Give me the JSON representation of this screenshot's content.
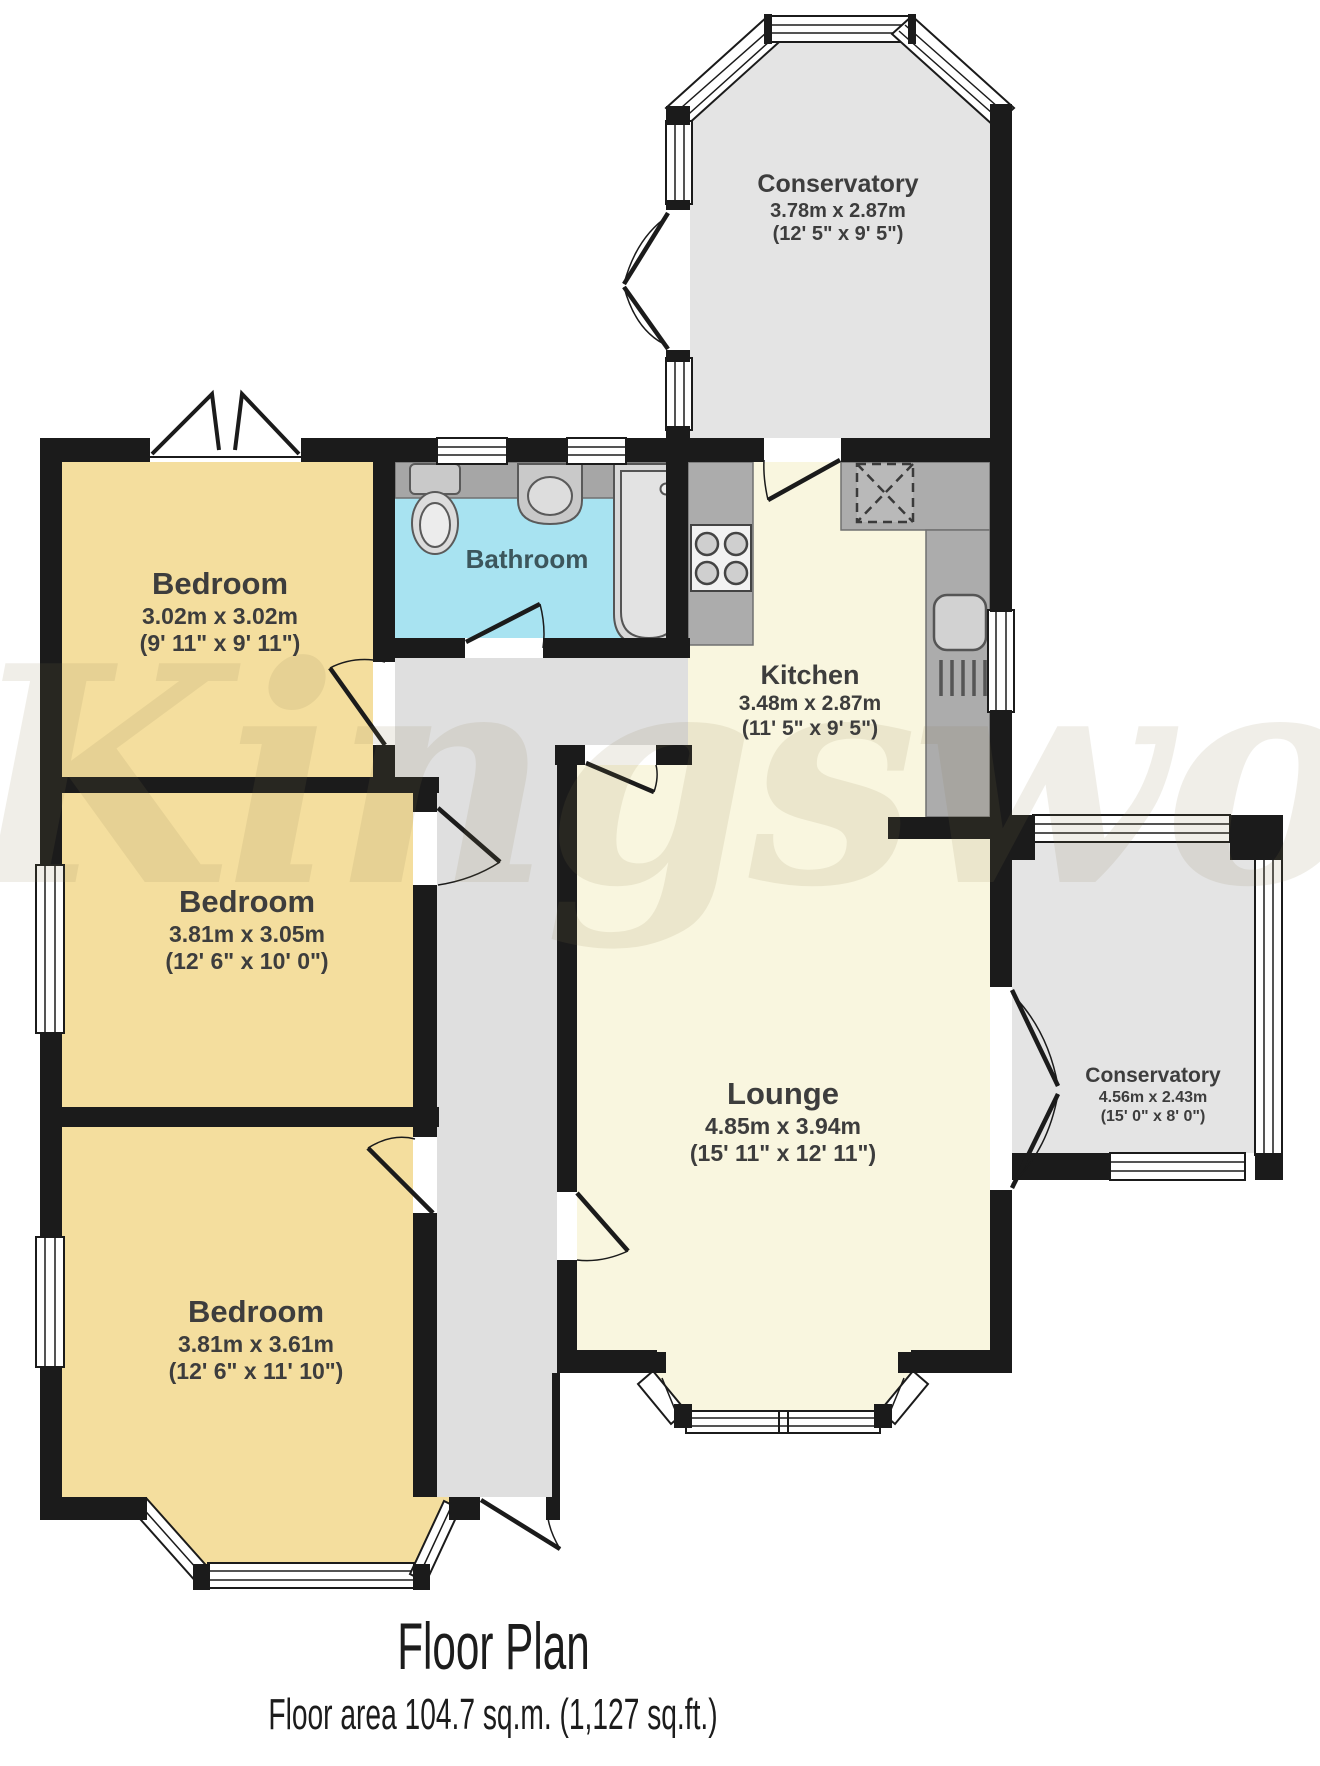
{
  "watermark_text": "Kingswood",
  "footer": {
    "title": "Floor Plan",
    "subtitle": "Floor area 104.7 sq.m. (1,127 sq.ft.)"
  },
  "rooms": {
    "conservatory_top": {
      "name": "Conservatory",
      "metric": "3.78m x 2.87m",
      "imperial": "(12' 5\" x 9' 5\")"
    },
    "bedroom_top": {
      "name": "Bedroom",
      "metric": "3.02m x 3.02m",
      "imperial": "(9' 11\" x 9' 11\")"
    },
    "bathroom": {
      "name": "Bathroom"
    },
    "kitchen": {
      "name": "Kitchen",
      "metric": "3.48m x 2.87m",
      "imperial": "(11' 5\" x 9' 5\")"
    },
    "bedroom_middle": {
      "name": "Bedroom",
      "metric": "3.81m x 3.05m",
      "imperial": "(12' 6\" x 10' 0\")"
    },
    "lounge": {
      "name": "Lounge",
      "metric": "4.85m x 3.94m",
      "imperial": "(15' 11\" x 12' 11\")"
    },
    "conservatory_right": {
      "name": "Conservatory",
      "metric": "4.56m x 2.43m",
      "imperial": "(15' 0\" x 8' 0\")"
    },
    "bedroom_bottom": {
      "name": "Bedroom",
      "metric": "3.81m x 3.61m",
      "imperial": "(12' 6\" x 11' 10\")"
    }
  },
  "colors": {
    "wall": "#1b1b1b",
    "bedroom_fill": "#F4DE9E",
    "living_fill": "#F9F6DF",
    "bathroom_fill": "#A8E3F1",
    "conservatory_fill": "#E4E4E4",
    "hall_fill": "#DFDFDF",
    "counter_fill": "#ACACAC",
    "fixture_fill": "#D9D9D9",
    "label_text": "#3d3d3d"
  }
}
